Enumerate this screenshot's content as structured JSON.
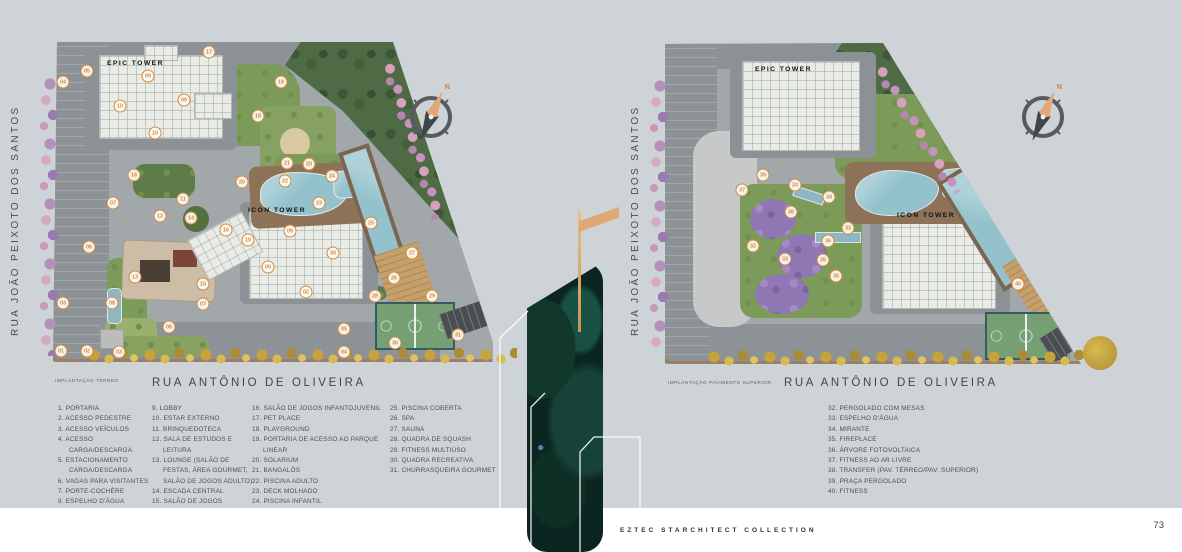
{
  "page": {
    "background": "#cdd3d6",
    "footer_brand": "EZTEC STARCHITECT COLLECTION",
    "page_number": "73",
    "accent_gold": "#cf8a3e",
    "marker_style": "white circle, orange border and number"
  },
  "plans": {
    "left": {
      "caption": "IMPLANTAÇÃO TÉRREO",
      "street_left": "RUA JOÃO PEIXOTO DOS SANTOS",
      "street_bottom": "RUA ANTÔNIO DE OLIVEIRA",
      "towers": {
        "epic": "EPIC TOWER",
        "icon": "ICON TOWER"
      },
      "compass_n": "N",
      "markers": [
        {
          "n": "17",
          "x": 164,
          "y": 16
        },
        {
          "n": "05",
          "x": 42,
          "y": 35
        },
        {
          "n": "04",
          "x": 18,
          "y": 46
        },
        {
          "n": "09",
          "x": 103,
          "y": 40
        },
        {
          "n": "09",
          "x": 139,
          "y": 64
        },
        {
          "n": "10",
          "x": 75,
          "y": 70
        },
        {
          "n": "10",
          "x": 110,
          "y": 97
        },
        {
          "n": "19",
          "x": 236,
          "y": 46
        },
        {
          "n": "18",
          "x": 213,
          "y": 80
        },
        {
          "n": "16",
          "x": 89,
          "y": 139
        },
        {
          "n": "21",
          "x": 242,
          "y": 127
        },
        {
          "n": "20",
          "x": 264,
          "y": 128
        },
        {
          "n": "20",
          "x": 197,
          "y": 146
        },
        {
          "n": "22",
          "x": 240,
          "y": 145
        },
        {
          "n": "24",
          "x": 287,
          "y": 140
        },
        {
          "n": "23",
          "x": 274,
          "y": 167
        },
        {
          "n": "07",
          "x": 68,
          "y": 167
        },
        {
          "n": "11",
          "x": 138,
          "y": 163
        },
        {
          "n": "12",
          "x": 115,
          "y": 180
        },
        {
          "n": "14",
          "x": 146,
          "y": 182
        },
        {
          "n": "25",
          "x": 326,
          "y": 187
        },
        {
          "n": "16",
          "x": 181,
          "y": 194
        },
        {
          "n": "10",
          "x": 203,
          "y": 204
        },
        {
          "n": "09",
          "x": 245,
          "y": 195
        },
        {
          "n": "06",
          "x": 44,
          "y": 211
        },
        {
          "n": "30",
          "x": 288,
          "y": 217
        },
        {
          "n": "27",
          "x": 367,
          "y": 217
        },
        {
          "n": "05",
          "x": 223,
          "y": 231
        },
        {
          "n": "13",
          "x": 90,
          "y": 241
        },
        {
          "n": "15",
          "x": 158,
          "y": 248
        },
        {
          "n": "26",
          "x": 349,
          "y": 242
        },
        {
          "n": "28",
          "x": 330,
          "y": 260
        },
        {
          "n": "29",
          "x": 387,
          "y": 260
        },
        {
          "n": "03",
          "x": 18,
          "y": 267
        },
        {
          "n": "08",
          "x": 67,
          "y": 267
        },
        {
          "n": "07",
          "x": 158,
          "y": 268
        },
        {
          "n": "02",
          "x": 261,
          "y": 256
        },
        {
          "n": "06",
          "x": 124,
          "y": 291
        },
        {
          "n": "05",
          "x": 299,
          "y": 293
        },
        {
          "n": "31",
          "x": 413,
          "y": 299
        },
        {
          "n": "30",
          "x": 350,
          "y": 307
        },
        {
          "n": "01",
          "x": 16,
          "y": 315
        },
        {
          "n": "02",
          "x": 42,
          "y": 315
        },
        {
          "n": "03",
          "x": 74,
          "y": 316
        },
        {
          "n": "04",
          "x": 299,
          "y": 316
        }
      ]
    },
    "right": {
      "caption": "IMPLANTAÇÃO PAVIMENTO SUPERIOR",
      "street_left": "RUA JOÃO PEIXOTO DOS SANTOS",
      "street_bottom": "RUA ANTÔNIO DE OLIVEIRA",
      "towers": {
        "epic": "EPIC TOWER",
        "icon": "ICON TOWER"
      },
      "compass_n": "N",
      "markers": [
        {
          "n": "39",
          "x": 108,
          "y": 139
        },
        {
          "n": "37",
          "x": 87,
          "y": 154
        },
        {
          "n": "33",
          "x": 140,
          "y": 149
        },
        {
          "n": "34",
          "x": 174,
          "y": 161
        },
        {
          "n": "38",
          "x": 136,
          "y": 176
        },
        {
          "n": "33",
          "x": 193,
          "y": 192
        },
        {
          "n": "36",
          "x": 173,
          "y": 205
        },
        {
          "n": "32",
          "x": 98,
          "y": 210
        },
        {
          "n": "33",
          "x": 130,
          "y": 223
        },
        {
          "n": "35",
          "x": 168,
          "y": 224
        },
        {
          "n": "36",
          "x": 181,
          "y": 240
        },
        {
          "n": "40",
          "x": 363,
          "y": 248
        }
      ]
    }
  },
  "legend": {
    "columns": [
      {
        "items": [
          "1. PORTARIA",
          "2. ACESSO PEDESTRE",
          "3. ACESSO VEÍCULOS",
          "4. ACESSO CARGA/DESCARGA",
          "5. ESTACIONAMENTO CARGA/DESCARGA",
          "6. VAGAS PARA VISITANTES",
          "7. PORTE-COCHÈRE",
          "8. ESPELHO D'ÁGUA"
        ]
      },
      {
        "items": [
          "9. LOBBY",
          "10. ESTAR EXTERNO",
          "11. BRINQUEDOTECA",
          "12. SALA DE ESTUDOS E LEITURA",
          "13. LOUNGE (SALÃO DE FESTAS, ÁREA GOURMET, SALÃO DE JOGOS ADULTO)",
          "14. ESCADA CENTRAL",
          "15. SALÃO DE JOGOS"
        ]
      },
      {
        "items": [
          "16. SALÃO DE JOGOS INFANTOJUVENIL",
          "17. PET PLACE",
          "18. PLAYGROUND",
          "19. PORTARIA DE ACESSO AO PARQUE LINEAR",
          "20. SOLARIUM",
          "21. BANGALÔS",
          "22. PISCINA ADULTO",
          "23. DECK MOLHADO",
          "24. PISCINA INFANTIL"
        ]
      },
      {
        "items": [
          "25. PISCINA COBERTA",
          "26. SPA",
          "27. SAUNA",
          "28. QUADRA DE SQUASH",
          "29. FITNESS MULTIÚSO",
          "30. QUADRA RECREATIVA",
          "31. CHURRASQUEIRA GOURMET"
        ]
      },
      {
        "items": [
          "32. PERGOLADO COM MESAS",
          "33. ESPELHO D'ÁGUA",
          "34. MIRANTE",
          "35. FIREPLACE",
          "36. ÁRVORE FOTOVOLTAICA",
          "37. FITNESS AO AR LIVRE",
          "38. TRANSFER (PAV. TÉRREO/PAV. SUPERIOR)",
          "39. PRAÇA PERGOLADO",
          "40. FITNESS"
        ]
      }
    ]
  }
}
